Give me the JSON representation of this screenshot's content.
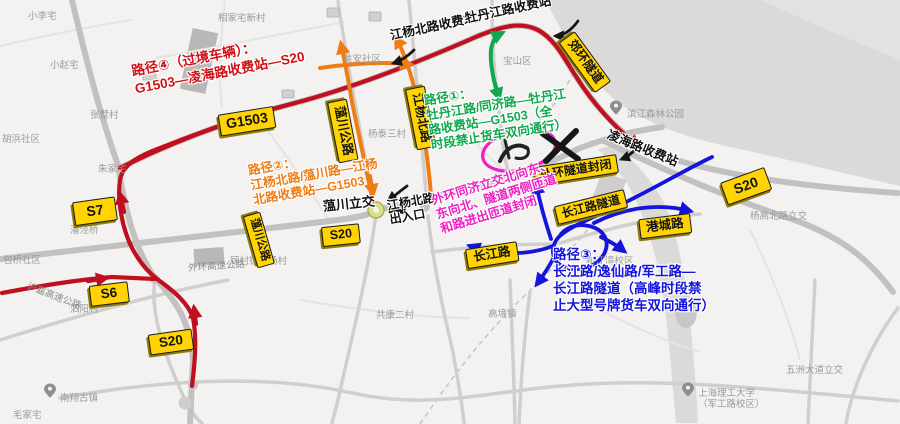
{
  "colors": {
    "route_red": "#c00f1e",
    "route_orange": "#ef7d14",
    "route_green": "#0fa84e",
    "route_blue": "#1414dc",
    "closure_magenta": "#ee1fc3",
    "badge_yellow": "#ffd400",
    "map_background": "#f3f2f0"
  },
  "routes": {
    "r4": [
      "路径④（过境车辆）：",
      "G1503—凌海路收费站—S20"
    ],
    "r1": [
      "路径①：",
      "牡丹江路/同济路—牡丹江",
      "路收费站—G1503（全",
      "时段禁止货车双向通行）"
    ],
    "r2": [
      "路径②：",
      "江杨北路/蕰川路—江杨",
      "北路收费站—G1503"
    ],
    "r3": [
      "路径③：",
      "长江路/逸仙路/军工路—",
      "长江路隧道（高峰时段禁",
      "止大型号牌货车双向通行）"
    ],
    "closure": [
      "外环同济立交北向东、",
      "东向北、隧道两侧匝道",
      "和路进出匝道封闭"
    ]
  },
  "stations": {
    "jiangyang_toll": "江杨北路收费站",
    "mudanjiang_toll": "牡丹江路收费站",
    "linghai_toll": "凌海路收费站"
  },
  "junctions": {
    "yunchuan_ic": "蕰川立交",
    "jiangyang_exit_1": "江杨北路",
    "jiangyang_exit_2": "出入口"
  },
  "badges": {
    "g1503": "G1503",
    "s7": "S7",
    "s6": "S6",
    "s20_west": "S20",
    "s20_mid": "S20",
    "s20_east": "S20",
    "yunchuan_north": "蕰川公路",
    "yunchuan_south": "蕰川公路",
    "jiangyang_rd": "江杨北路",
    "jiaohuan_tunnel": "郊环隧道",
    "waihuan_closed": "外环隧道封闭",
    "changjiang_tunnel": "长江路隧道",
    "changjiang_rd": "长江路",
    "gangcheng_rd": "港城路"
  },
  "labels": [
    "小李宅",
    "相家宅新村",
    "小赵宅",
    "张墅村",
    "胡浜社区",
    "共安社区",
    "宝山区",
    "杨泰三村",
    "滨江森林公园",
    "朱家宅",
    "潘泾桥",
    "包桥社区",
    "顾村镇白杨村",
    "泗阳村",
    "南翔古镇",
    "毛家宅",
    "共康二村",
    "高境镇",
    "新江湾校区",
    "上海理工大学",
    "（军工路校区）",
    "杨高北路立交",
    "五洲大道立交",
    "沪嘉高速公路",
    "外环高速公路"
  ]
}
